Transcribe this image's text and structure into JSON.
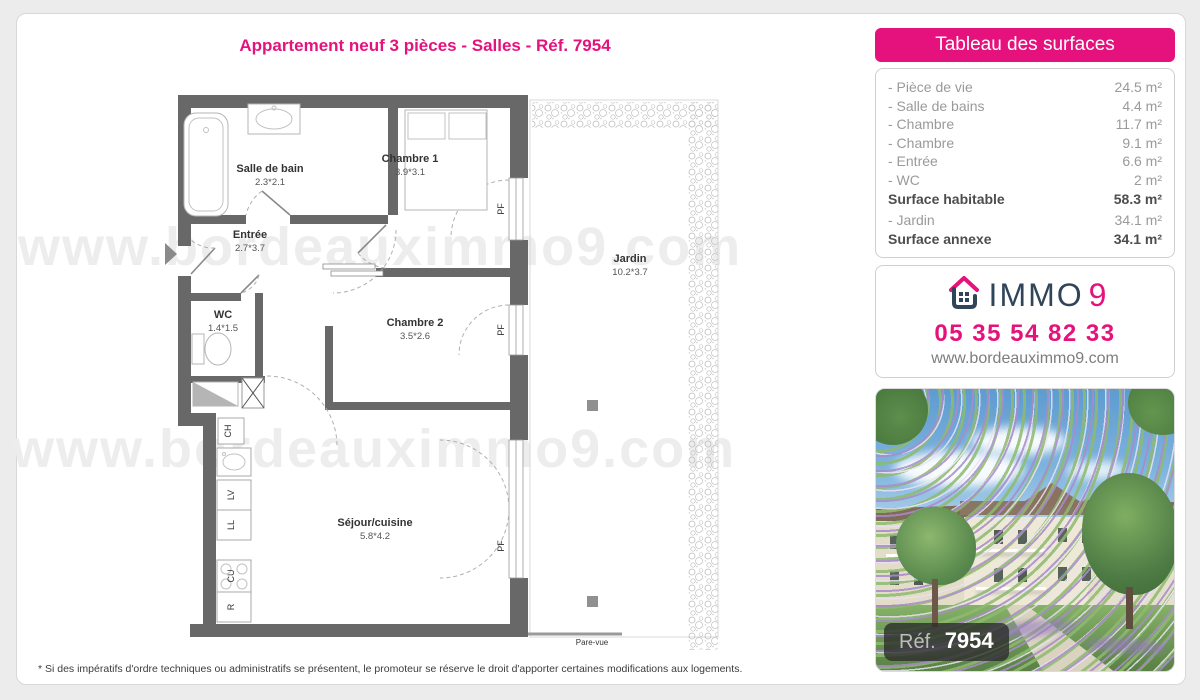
{
  "page": {
    "title": "Appartement neuf 3 pièces - Salles - Réf. 7954",
    "watermark": "www.bordeauximmo9.com",
    "footnote": "* Si des impératifs d'ordre techniques ou administratifs se présentent, le promoteur se réserve le droit d'apporter certaines modifications aux logements."
  },
  "surfaces_panel": {
    "header": "Tableau des surfaces",
    "rows": [
      {
        "label": "- Pièce de vie",
        "value": "24.5 m²"
      },
      {
        "label": "- Salle de bains",
        "value": "4.4 m²"
      },
      {
        "label": "- Chambre",
        "value": "11.7 m²"
      },
      {
        "label": "- Chambre",
        "value": "9.1 m²"
      },
      {
        "label": "- Entrée",
        "value": "6.6 m²"
      },
      {
        "label": "- WC",
        "value": "2 m²"
      },
      {
        "label": "Surface habitable",
        "value": "58.3 m²"
      },
      {
        "label": "- Jardin",
        "value": "34.1 m²"
      },
      {
        "label": "Surface annexe",
        "value": "34.1 m²"
      }
    ]
  },
  "agency": {
    "brand_main": "IMMO",
    "brand_digit": "9",
    "phone": "05 35 54 82 33",
    "website": "www.bordeauximmo9.com"
  },
  "photo": {
    "ref_label": "Réf.",
    "ref_number": "7954"
  },
  "floorplan": {
    "rooms": [
      {
        "name": "Salle de bain",
        "dims": "2.3*2.1"
      },
      {
        "name": "Chambre 1",
        "dims": "3.9*3.1"
      },
      {
        "name": "Entrée",
        "dims": "2.7*3.7"
      },
      {
        "name": "WC",
        "dims": "1.4*1.5"
      },
      {
        "name": "Chambre 2",
        "dims": "3.5*2.6"
      },
      {
        "name": "Séjour/cuisine",
        "dims": "5.8*4.2"
      },
      {
        "name": "Jardin",
        "dims": "10.2*3.7"
      }
    ],
    "appliances": [
      "CH",
      "LV",
      "LL",
      "CU",
      "R"
    ],
    "window_label": "PF",
    "fence_label": "Pare-vue"
  },
  "colors": {
    "accent": "#e5127d",
    "navy": "#31455a",
    "wall_gray": "#686868"
  }
}
